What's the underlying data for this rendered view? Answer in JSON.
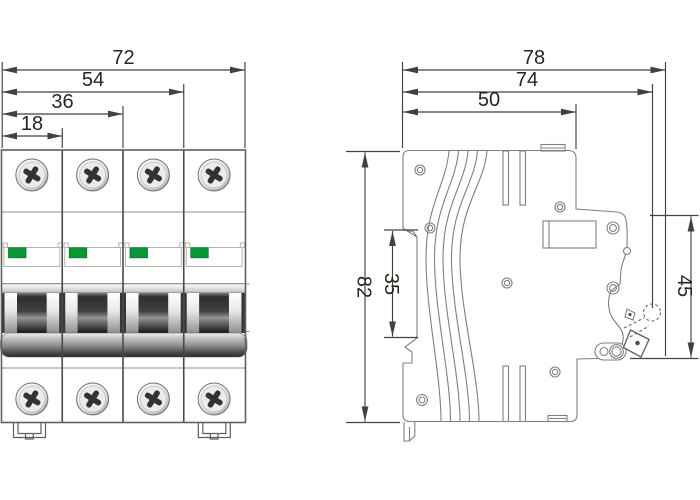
{
  "front_view": {
    "description": "4-pole circuit breaker, front elevation",
    "poles": 4,
    "dim_labels": {
      "overall_width": "72",
      "three_pole_width": "54",
      "two_pole_width": "36",
      "one_pole_width": "18"
    },
    "indicator_color": "#089636"
  },
  "side_view": {
    "description": "circuit breaker side profile on DIN rail",
    "dim_labels": {
      "depth_total": "78",
      "depth_to_handle": "74",
      "base_depth": "50",
      "height": "82",
      "din_groove_height": "35",
      "front_face_height": "45"
    }
  },
  "colors": {
    "dimension_lines": "#45403a",
    "dimension_text": "#2a2520",
    "body_outline": "#616161",
    "side_outline": "#847e77",
    "indicator_green": "#089636"
  }
}
